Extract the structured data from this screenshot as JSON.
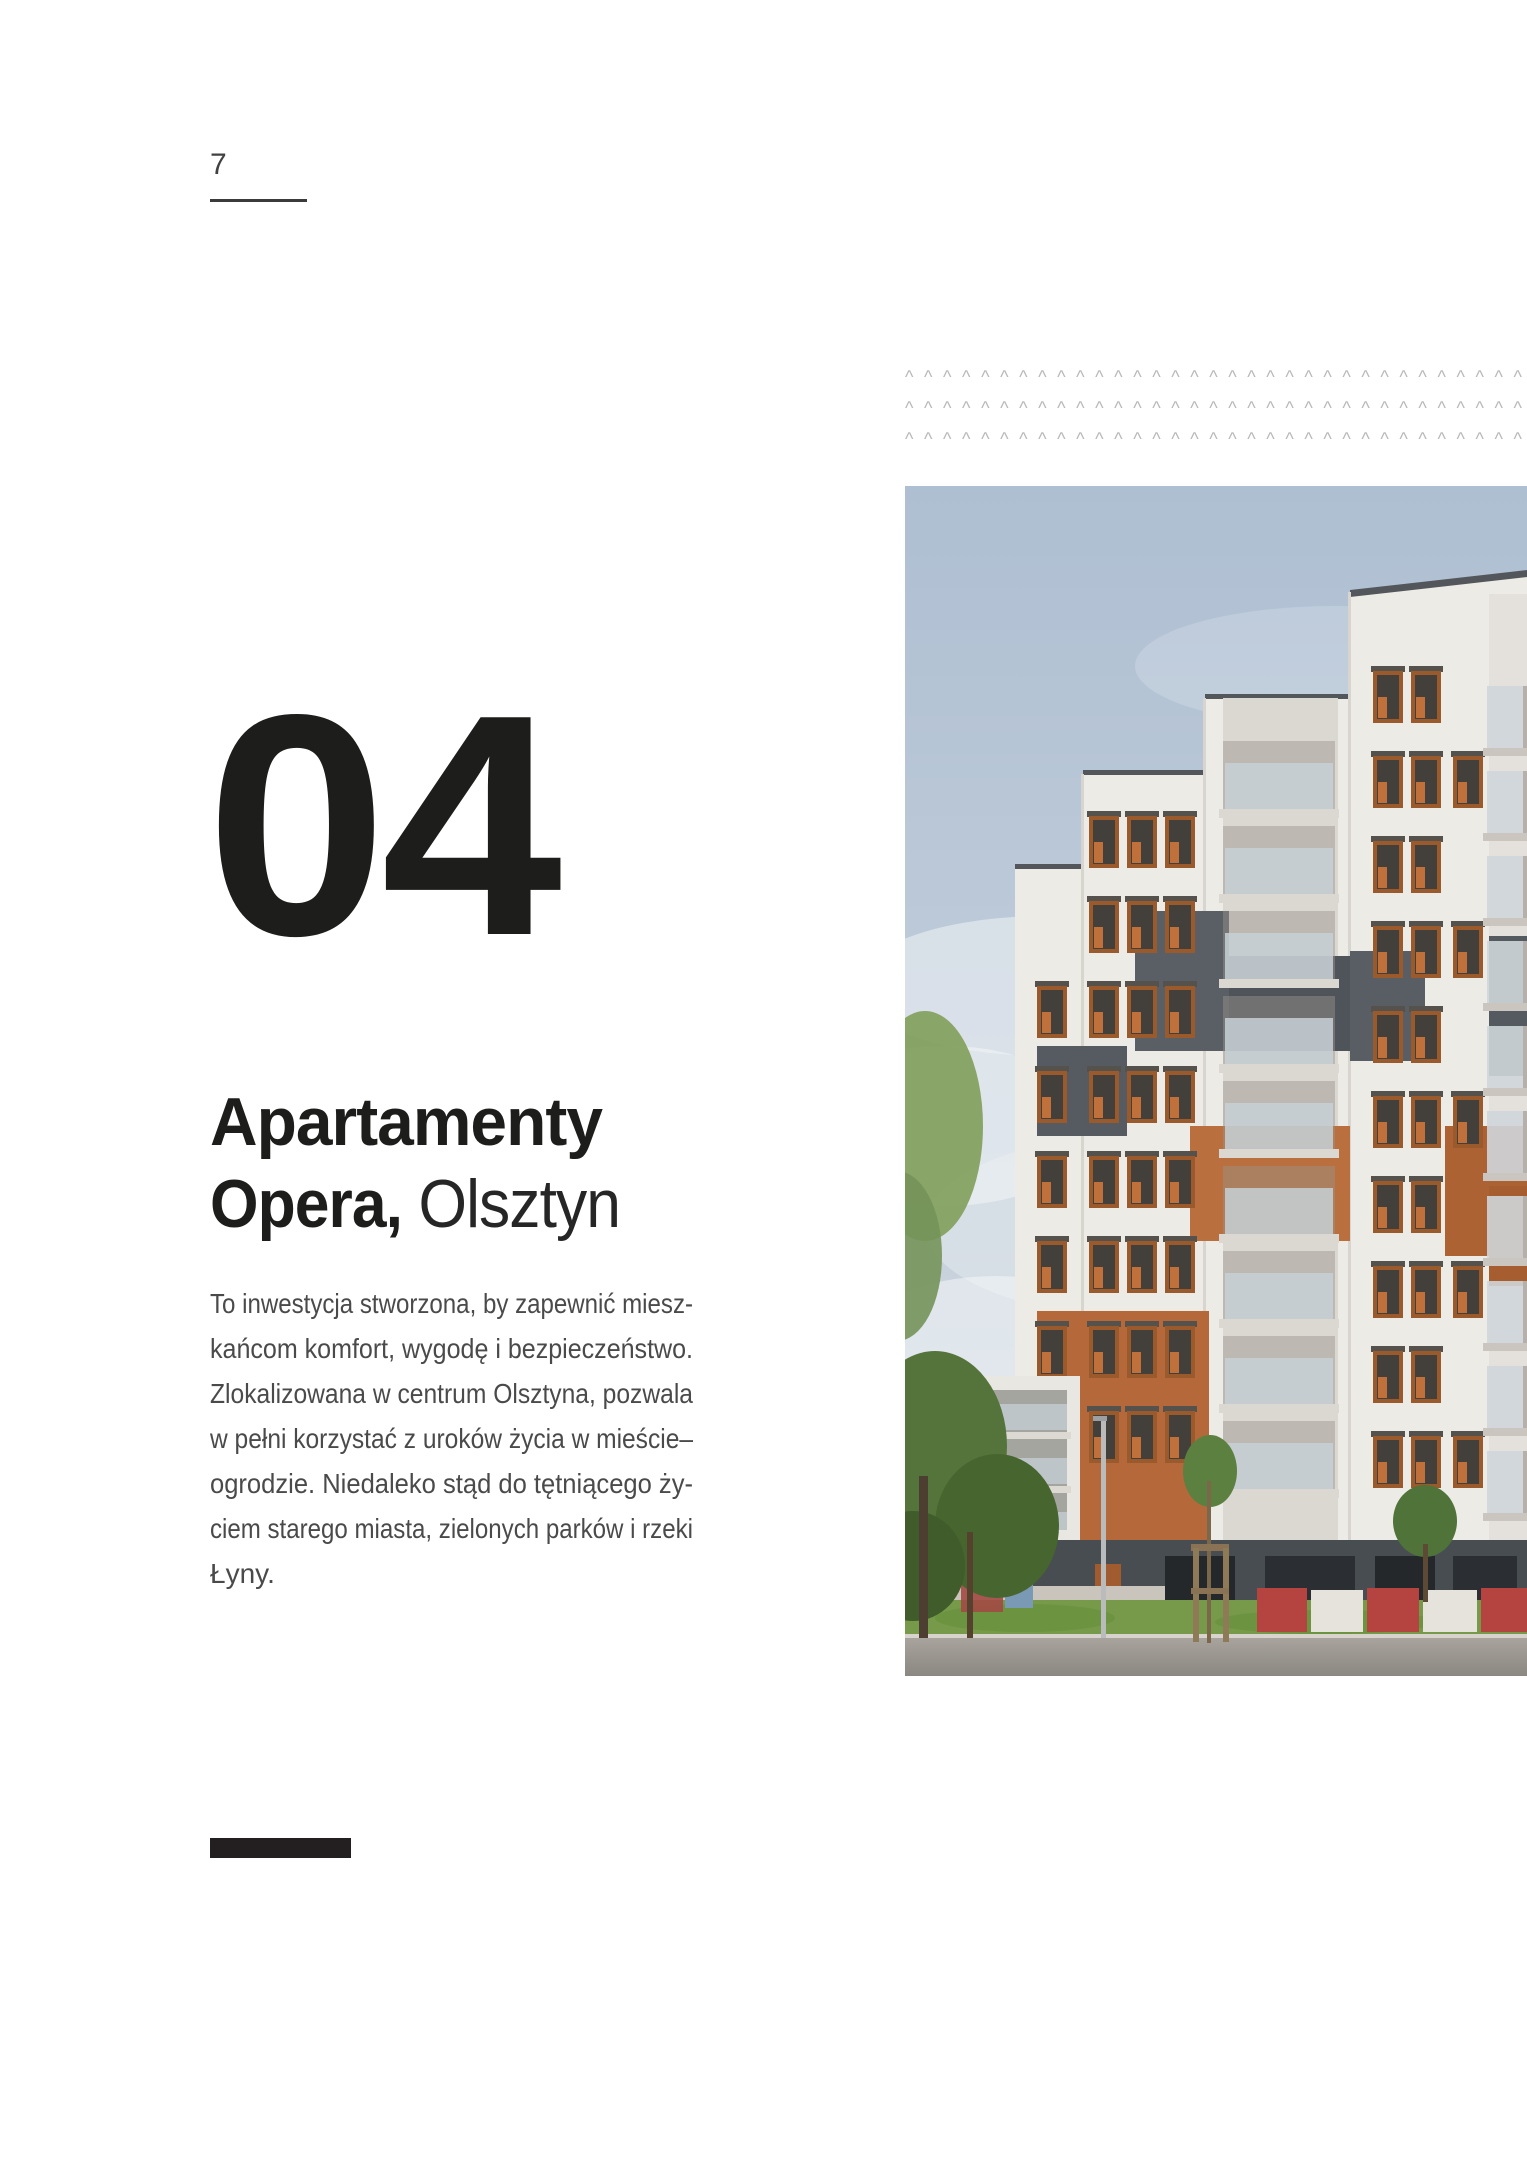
{
  "page": {
    "number": "7"
  },
  "section": {
    "index": "04",
    "title_line1_bold": "Apartamenty",
    "title_line2_bold": "Opera,",
    "title_line2_light": "Olsztyn",
    "paragraph_lines": [
      "To inwestycja stworzona, by zapewnić miesz-",
      "kańcom komfort, wygodę i bezpieczeństwo.",
      "Zlokalizowana w centrum Olsztyna, pozwala",
      "w pełni korzystać z uroków życia w mieście–",
      "ogrodzie. Niedaleko stąd do tętniącego ży-",
      "ciem starego miasta, zielonych parków i rzeki",
      "Łyny."
    ]
  },
  "decor": {
    "chevron_glyph": "^",
    "chevron_rows": 3,
    "chevron_cols": 33
  },
  "colors": {
    "heading_black": "#1d1d1b",
    "body_gray": "#4a4a4a",
    "chevron_gray": "#b9b9b9",
    "bar_black": "#231f20",
    "facade_white": "#edebe6",
    "panel_gray": "#5a5f65",
    "panel_orange": "#b5693a"
  }
}
